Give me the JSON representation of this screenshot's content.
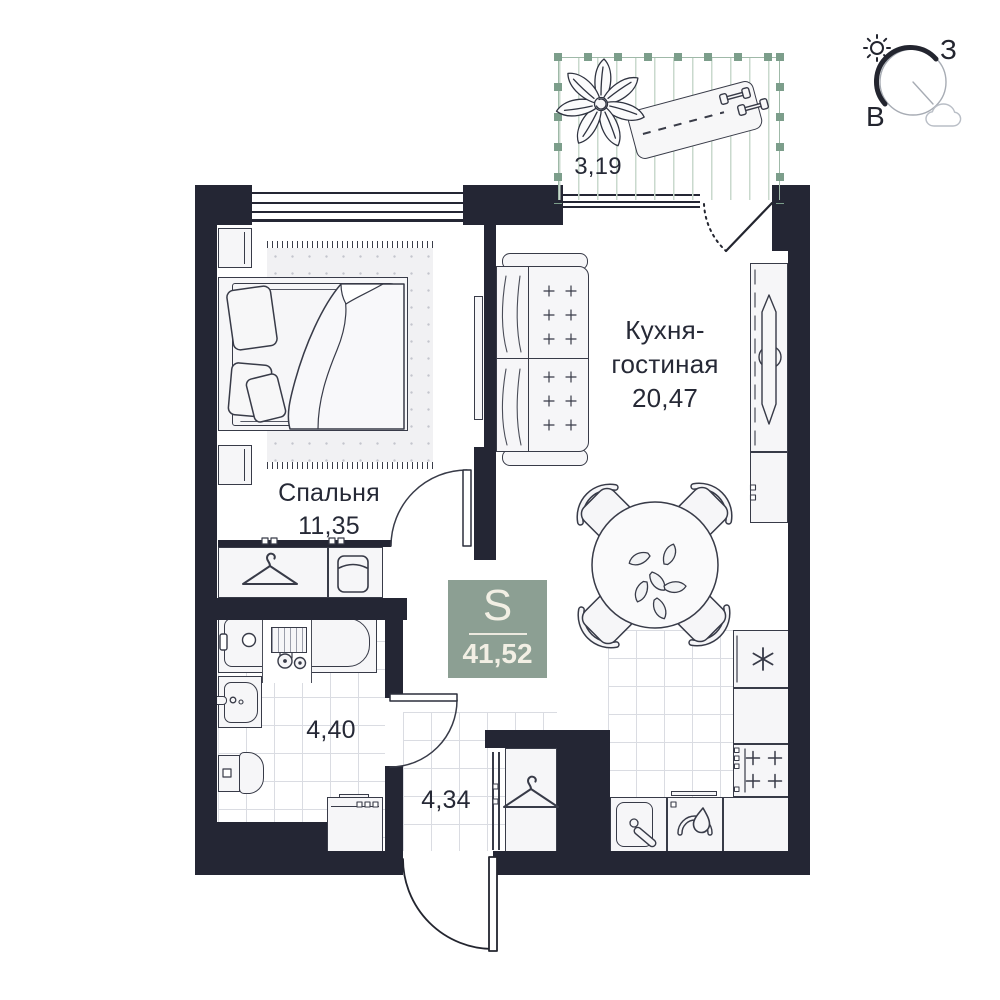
{
  "rooms": {
    "bedroom": {
      "name": "Спальня",
      "area": "11,35"
    },
    "kitchen_living": {
      "name_line1": "Кухня-",
      "name_line2": "гостиная",
      "area": "20,47"
    },
    "bathroom": {
      "area": "4,40"
    },
    "hallway": {
      "area": "4,34"
    },
    "balcony": {
      "area": "3,19"
    }
  },
  "badge": {
    "label": "S",
    "value": "41,52"
  },
  "compass": {
    "west": "З",
    "east": "В"
  },
  "colors": {
    "wall": "#242634",
    "badge_green": "#8c9f93",
    "balcony_green": "#7c9e8b",
    "balcony_hatch": "#c9d9cd",
    "furniture_stroke": "#383b48",
    "tile_line": "#dadce2",
    "text": "#262936"
  },
  "icons": {
    "hanger-icon": "clothes hanger outline",
    "plant-icon": "plant leaves top view",
    "table-plant-icon": "small vine on dining table",
    "sun-icon": "sun with rays",
    "cloud-icon": "cloud outline",
    "freezer-asterisk-icon": "6-ray asterisk (fridge)",
    "burner-icon": "plus-shaped hob burner",
    "dumbbell-icon": "two dumbbells on mat",
    "shower-mixer-icon": "bath mixer with two knobs",
    "storage-box-icon": "basket in wardrobe"
  }
}
